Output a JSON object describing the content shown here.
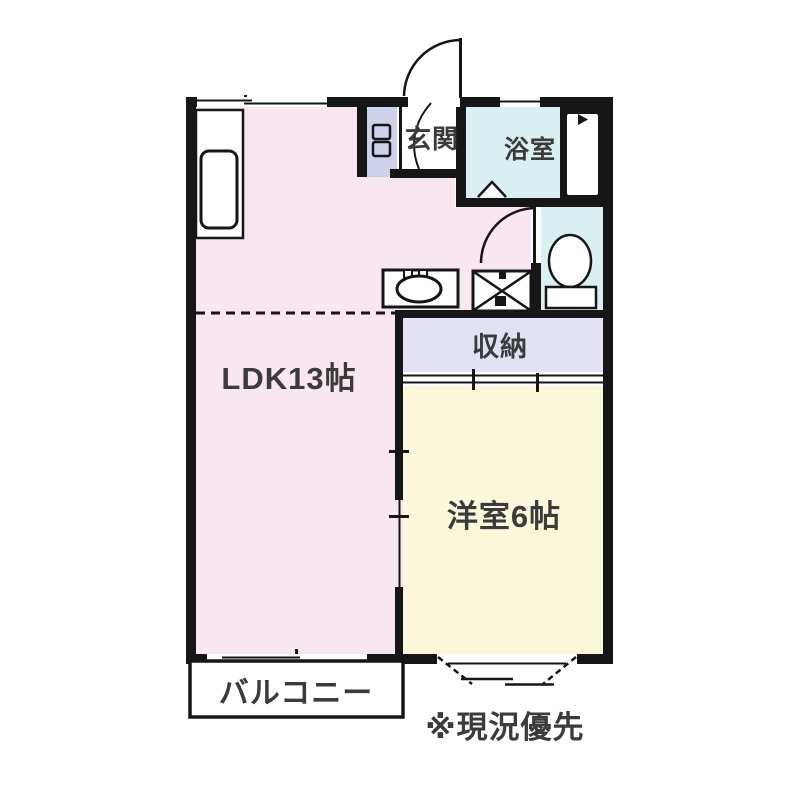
{
  "rooms": {
    "ldk": {
      "label": "LDK13帖"
    },
    "western": {
      "label": "洋室6帖"
    },
    "closet": {
      "label": "収納"
    },
    "bathroom": {
      "label": "浴室"
    },
    "entrance": {
      "label": "玄関"
    },
    "balcony": {
      "label": "バルコニー"
    }
  },
  "note": {
    "text": "※現況優先"
  },
  "fixtures": [
    "entrance-door-swing",
    "entrance-inner-door-swing",
    "shoe-cabinet",
    "bathroom-folding-door",
    "water-heater",
    "toilet",
    "toilet-door-swing",
    "washing-machine-pan",
    "kitchen-sink",
    "kitchen-counter-unit",
    "sliding-window-top",
    "sliding-window-bathroom",
    "sliding-window-ldk-bottom",
    "bay-window-western-room",
    "sliding-door-ldk-western",
    "closet-sliding-doors",
    "kitchen-area-dashed-divider"
  ],
  "colors": {
    "ldk_pink": "#f8e7f0",
    "western_yellow": "#faf7da",
    "wet_area_cyan": "#d9eff1",
    "closet_lavender": "#e2e2f4",
    "shoe_cabinet_lavender": "#cdd1e9",
    "wall_black": "#161616",
    "label_gray": "#3b3b3b",
    "background": "#ffffff"
  }
}
